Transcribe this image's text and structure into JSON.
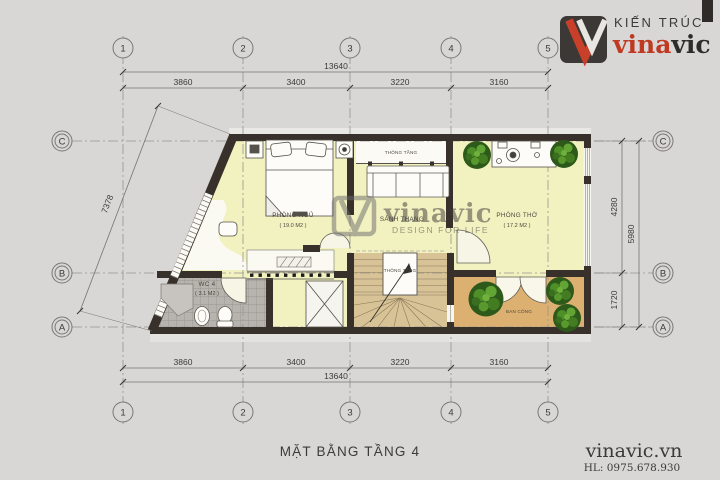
{
  "brand": {
    "tagline": "KIẾN TRÚC",
    "name_red": "vina",
    "name_dark": "vic",
    "website": "vinavic.vn",
    "hotline": "HL: 0975.678.930"
  },
  "watermark": {
    "name": "vinavic",
    "slogan": "DESIGN FOR LIFE"
  },
  "drawing": {
    "title": "MẶT BẰNG TẦNG 4"
  },
  "grid": {
    "cols": [
      "1",
      "2",
      "3",
      "4",
      "5"
    ],
    "rows": [
      "C",
      "B",
      "A"
    ]
  },
  "dims": {
    "total": "13640",
    "segments": [
      "3860",
      "3400",
      "3220",
      "3160"
    ],
    "right_upper": "4280",
    "right_total": "5980",
    "right_lower": "1720",
    "diagonal": "7378"
  },
  "rooms": {
    "bedroom": {
      "name": "PHÒNG NGỦ",
      "area": "( 19.0 M2 )"
    },
    "stair_hall": {
      "name": "SẢNH THANG"
    },
    "worship": {
      "name": "PHÒNG THỜ",
      "area": "( 17.2 M2 )"
    },
    "wc": {
      "name": "WC 4",
      "area": "( 3.1 M2 )"
    },
    "balcony": {
      "name": "BAN CÔNG"
    },
    "void": {
      "name": "THÔNG TẦNG"
    }
  },
  "colors": {
    "accent_red": "#c03a22",
    "wall_dark": "#38302a",
    "floor_yellow": "#f2f1c0",
    "stair_tan": "#d8c396",
    "balcony_tan": "#dcb071",
    "background": "#d8d7d5"
  }
}
